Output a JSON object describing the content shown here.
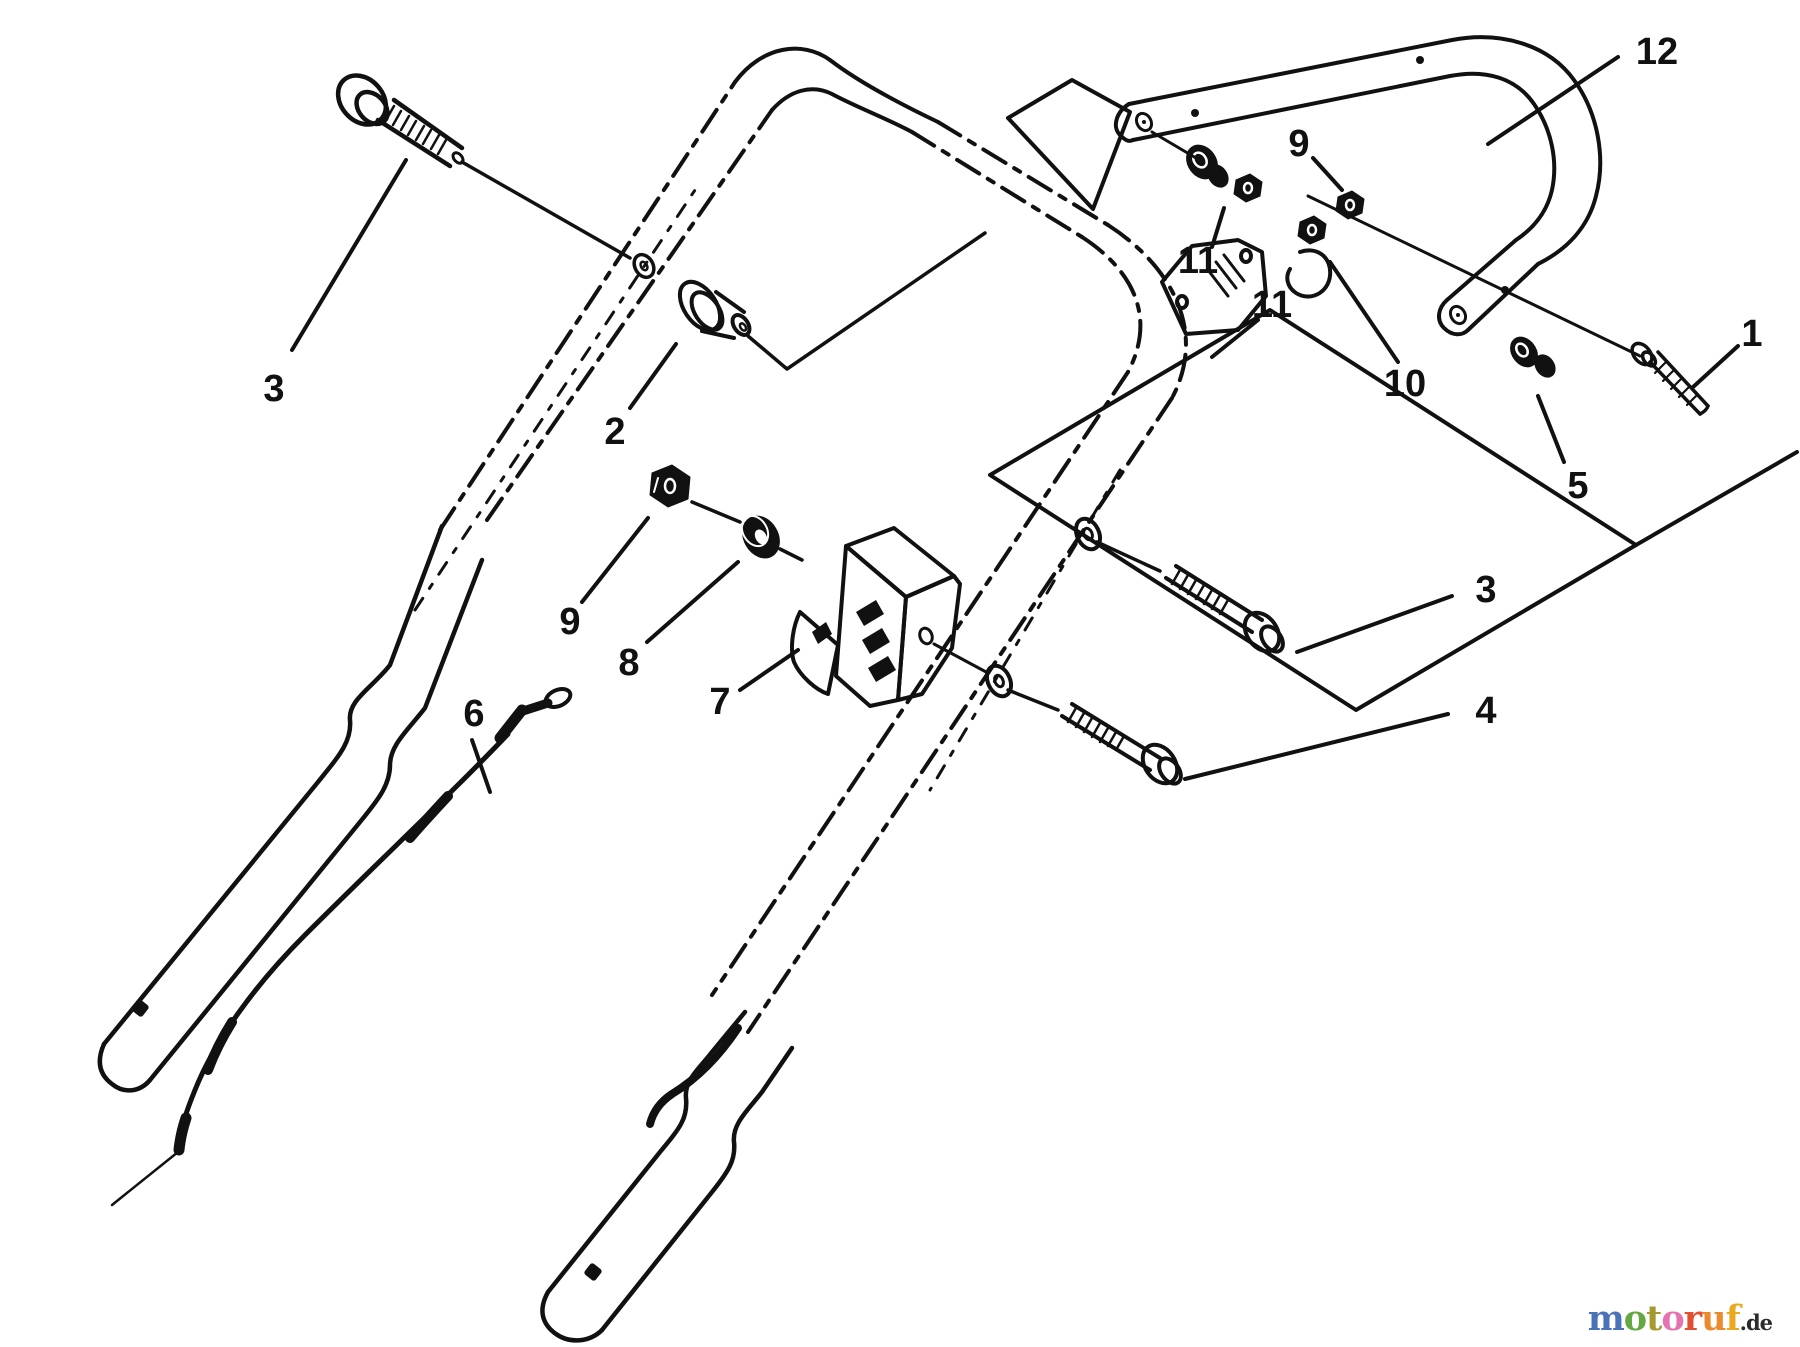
{
  "figure": {
    "background": "#ffffff",
    "ink": "#111111",
    "description": "Exploded parts diagram of a mower handle assembly"
  },
  "callouts": [
    {
      "part": "12"
    },
    {
      "part": "9"
    },
    {
      "part": "11"
    },
    {
      "part": "11"
    },
    {
      "part": "10"
    },
    {
      "part": "1"
    },
    {
      "part": "5"
    },
    {
      "part": "3"
    },
    {
      "part": "4"
    },
    {
      "part": "3"
    },
    {
      "part": "2"
    },
    {
      "part": "9"
    },
    {
      "part": "8"
    },
    {
      "part": "7"
    },
    {
      "part": "6"
    }
  ],
  "watermark": {
    "letters": [
      {
        "ch": "m",
        "color": "#4a72b8"
      },
      {
        "ch": "o",
        "color": "#64a844"
      },
      {
        "ch": "t",
        "color": "#a59a2e"
      },
      {
        "ch": "o",
        "color": "#e473b2"
      },
      {
        "ch": "r",
        "color": "#e14f30"
      },
      {
        "ch": "u",
        "color": "#ea8b2e"
      },
      {
        "ch": "f",
        "color": "#eaa91e"
      }
    ],
    "suffix": ".de",
    "suffix_color": "#2b2b2b"
  }
}
